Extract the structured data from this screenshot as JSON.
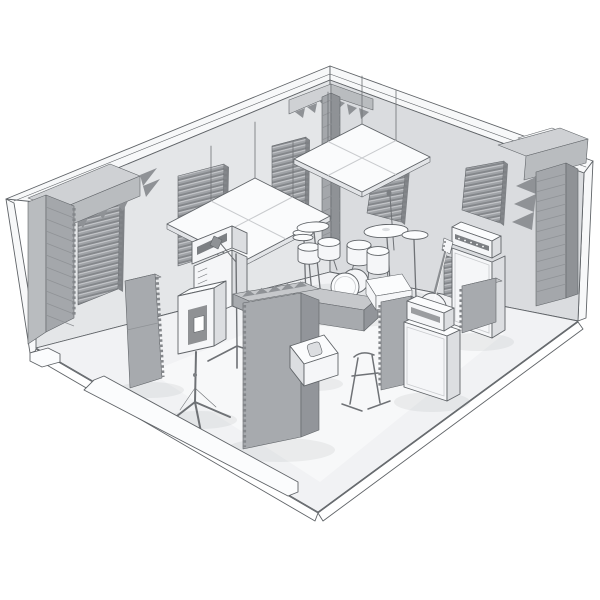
{
  "meta": {
    "type": "3d-render",
    "subject": "Isometric cutaway 3D render of a soundproofed band rehearsal room with acoustic foam treatment, drum kit, guitar and bass amplifiers, PA speaker and microphone stands",
    "style": "monochrome greyscale line-art render, near walls removed",
    "canvas": {
      "width": 600,
      "height": 600
    }
  },
  "palette": {
    "background": "#ffffff",
    "outline": "#606468",
    "wall_edge": "#f7f8f9",
    "wall_left": "#e4e6e8",
    "wall_right": "#dadcdf",
    "floor": "#f1f2f4",
    "foam_base": "#9fa2a6",
    "foam_dark": "#84878b",
    "foam_light": "#c8cacd",
    "foam_edge": "#7e8185",
    "trap_top": "#cfd1d4",
    "trap_light": "#b9bcbf",
    "trap_mid": "#a4a7ab",
    "trap_dark": "#8f9296",
    "gobo_top": "#c6c8cb",
    "gobo_face": "#a7aaae",
    "gobo_side": "#92959a",
    "cloud": "#fafbfc",
    "cloud_side": "#e3e5e8",
    "gear_white": "#f5f6f8",
    "gear_light": "#fbfcfd",
    "gear_shade": "#dcdee1",
    "gear_dark": "#7c7f83",
    "metal": "#6f7276"
  },
  "scene": {
    "room": {
      "view": "isometric from above-front, near walls cut away",
      "walls_visible": [
        "back-left wall",
        "back-right wall"
      ],
      "floor_slab": "thin slab with visible edge thickness and base sills along the cut edges"
    },
    "acoustic_treatment": {
      "corner_bass_traps": [
        "left corner column with top beam",
        "back corner column with two top wings",
        "right corner column with top beam"
      ],
      "wall_foam_panels": [
        "back-left wall: 3 wedge panels",
        "back-right wall: 3 wedge panels"
      ],
      "ceiling_clouds": [
        "left 2x2 hanging panel grid",
        "right 2x2 hanging panel grid"
      ],
      "gobos": [
        "tall slab left of drums",
        "L-shaped gobo with pyramid foam top in front of drums",
        "serrated slab near 4x12 cab",
        "serrated slab near bass stack"
      ]
    },
    "equipment": {
      "drum_kit": "5-piece kit: kick, snare, two rack toms, floor tom, hi-hat, crash and ride cymbals",
      "guitar_amp": "amp head on cabinet against back-left wall with microphone on boom stand",
      "pa_speaker": "moulded PA speaker on tripod pole stand",
      "bass_stack": "bass head on tall 8x10 cabinet against back-right wall",
      "cab_4x12": "4x12 speaker cabinet with amp head",
      "bass_guitar": "bass guitar on floor stand",
      "guitar_stand": "empty A-frame guitar stand",
      "monitors": [
        "wedge floor monitor",
        "tilted monitor behind gobo"
      ],
      "mic_stands": [
        "boom microphone stand at guitar amp",
        "straight microphone stand behind drums"
      ]
    }
  }
}
